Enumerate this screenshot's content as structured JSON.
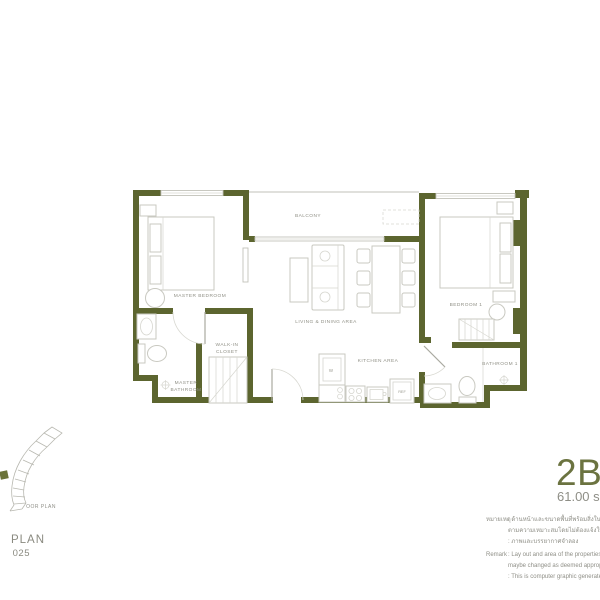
{
  "colors": {
    "wall": "#5c652f",
    "accent": "#6b7340",
    "text_gray": "#8f8f87",
    "line_light": "#c9c9c1"
  },
  "plan": {
    "rooms": {
      "balcony": "BALCONY",
      "master_bedroom": "MASTER BEDROOM",
      "living_dining": "LIVING & DINING AREA",
      "kitchen": "KITCHEN AREA",
      "bedroom1": "BEDROOM 1",
      "walk_in_line1": "WALK-IN",
      "walk_in_line2": "CLOSET",
      "master_bath_line1": "MASTER",
      "master_bath_line2": "BATHROOM",
      "bathroom1": "BATHROOM 1"
    },
    "fixtures": {
      "washer": "W",
      "fridge": "REF"
    }
  },
  "keyplan": {
    "caption": "OOR PLAN",
    "big_line1": "PLAN",
    "big_line2": "025"
  },
  "title": {
    "model": "2B-",
    "area": "61.00 s"
  },
  "remark": {
    "lines": [
      {
        "label": "หมายเหตุ",
        "text": ": ด้านหน้าและขนาดพื้นที่พร้อมสิ่งในอาคารนี้ และอ"
      },
      {
        "label": "",
        "text": "ตามความเหมาะสมโดยไม่ต้องแจ้งให้ทราบล่วงหน้า"
      },
      {
        "label": "",
        "text": ": ภาพและบรรยากาศจำลอง"
      },
      {
        "label": "Remark",
        "text": ": Lay out and area of the properties which is"
      },
      {
        "label": "",
        "text": "maybe changed as deemed appropriate b"
      },
      {
        "label": "",
        "text": ": This is computer graphic generated"
      }
    ]
  }
}
